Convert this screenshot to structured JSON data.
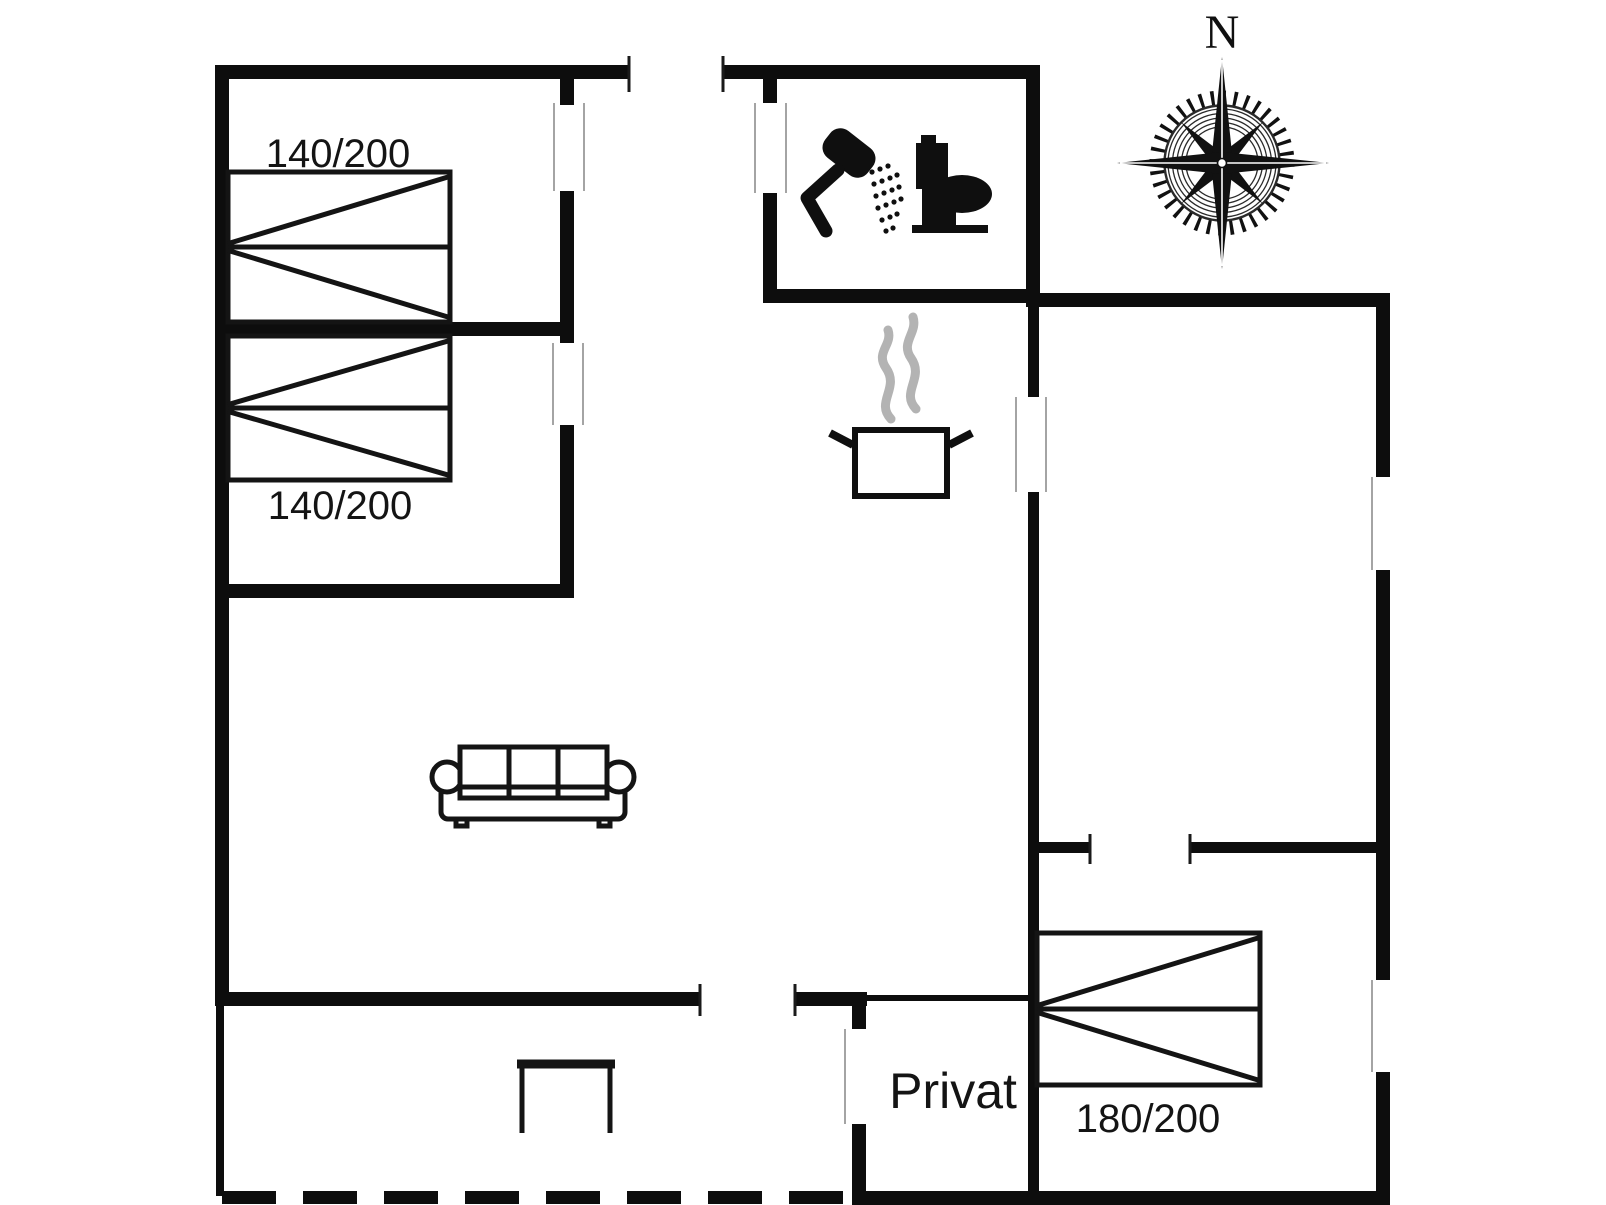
{
  "document": {
    "kind": "holiday-house-floor-plan"
  },
  "palette": {
    "background": "#ffffff",
    "wall": "#0d0d0d",
    "furniture": "#141414",
    "icon": "#0f0f0f",
    "jamb": "#9a9a9a",
    "tick": "#1a1a1a",
    "steam": "#b3b3b3"
  },
  "labels": {
    "bed_top": "140/200",
    "bed_bottom": "140/200",
    "bed_right": "180/200",
    "private_room": "Privat",
    "compass_north": "N"
  },
  "icons": {
    "bathroom": [
      "shower-icon",
      "toilet-icon"
    ],
    "kitchen": [
      "cooking-pot-icon",
      "steam-icon"
    ],
    "navigation": [
      "compass-rose-icon"
    ],
    "furniture": [
      "double-bed-icon",
      "double-bed-icon",
      "double-bed-icon",
      "sofa-icon",
      "table-icon"
    ]
  }
}
